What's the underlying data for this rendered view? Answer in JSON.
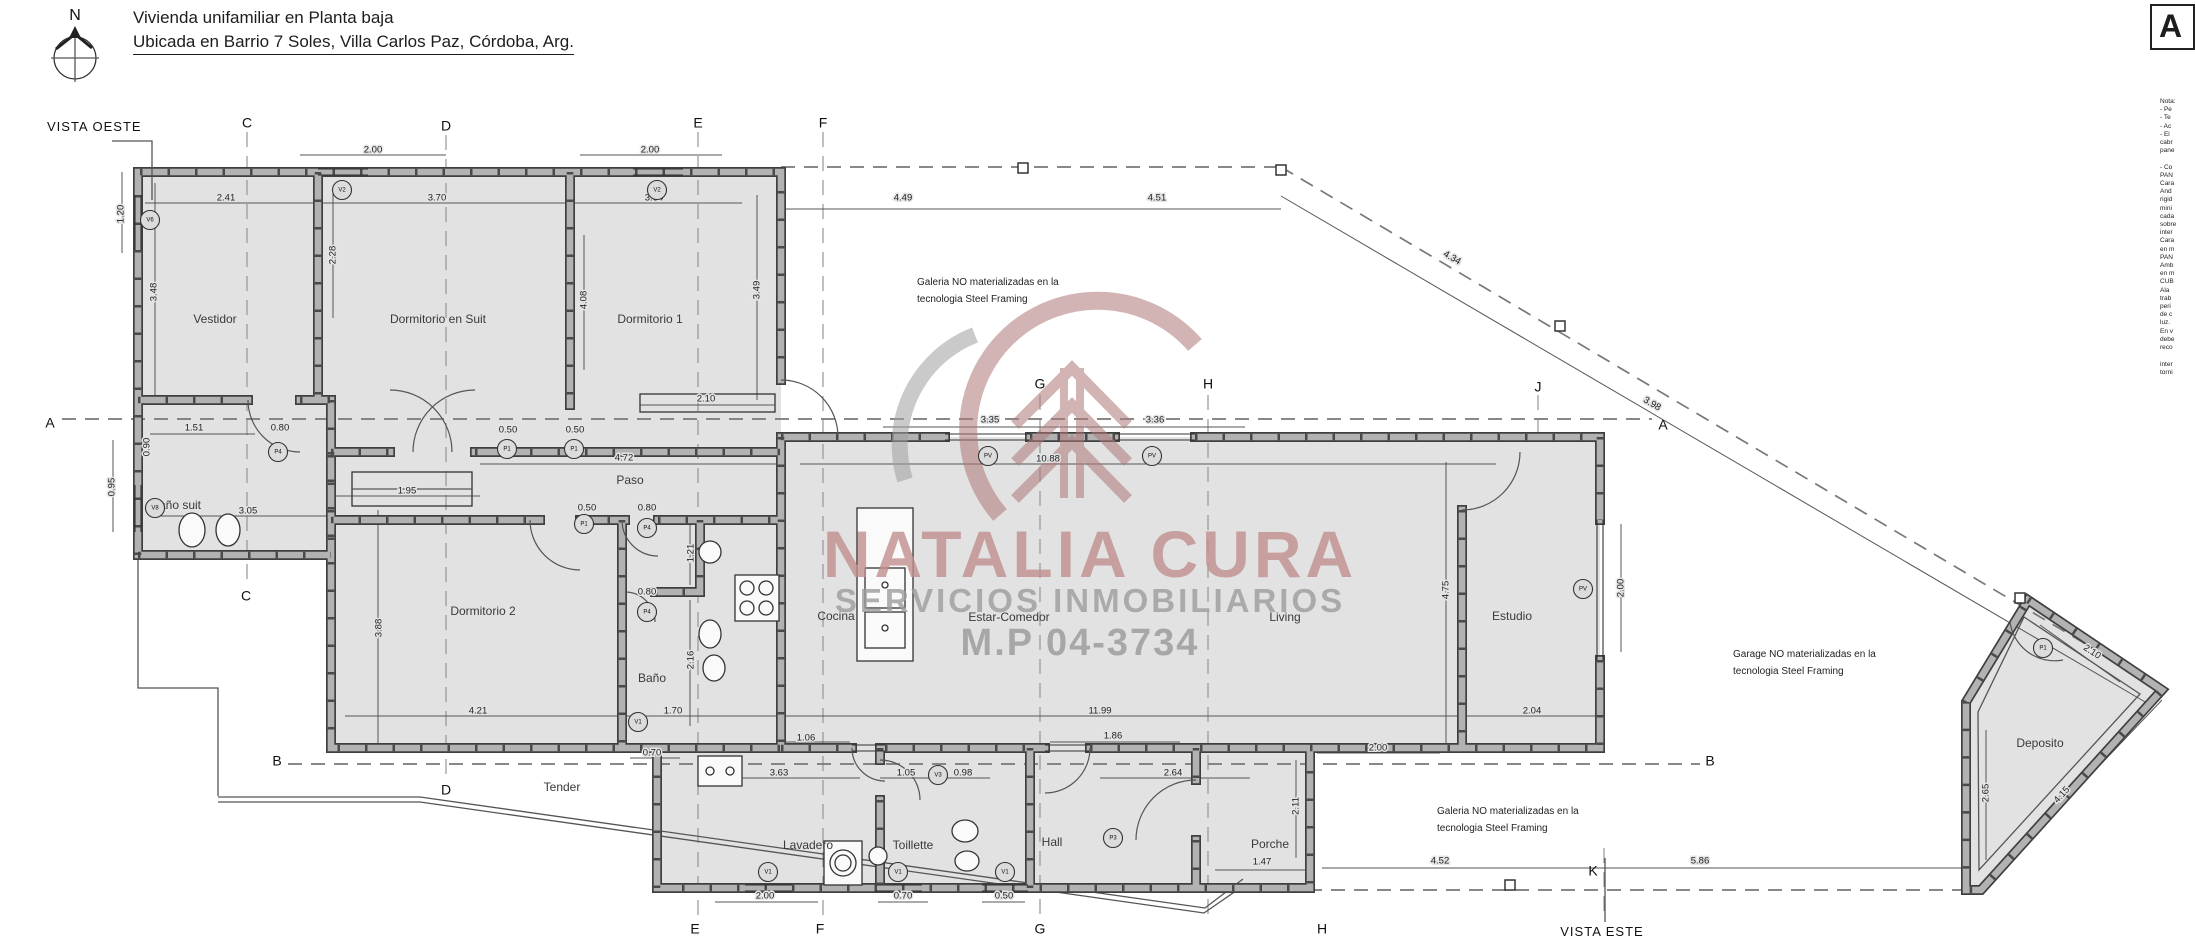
{
  "header": {
    "north_letter": "N",
    "title": "Vivienda unifamiliar en Planta baja",
    "subtitle": "Ubicada en Barrio 7 Soles, Villa Carlos Paz, Córdoba, Arg."
  },
  "views": {
    "west": "VISTA OESTE",
    "east": "VISTA ESTE"
  },
  "watermark": {
    "name": "NATALIA CURA",
    "tagline": "SERVICIOS INMOBILIARIOS",
    "license": "M.P 04-3734",
    "name_color": "#c18f8f",
    "gray_color": "#9d9d9d"
  },
  "rooms": [
    {
      "name": "Vestidor",
      "x": 215,
      "y": 320
    },
    {
      "name": "Dormitorio en Suit",
      "x": 438,
      "y": 320
    },
    {
      "name": "Dormitorio 1",
      "x": 650,
      "y": 320
    },
    {
      "name": "Baño suit",
      "x": 176,
      "y": 506
    },
    {
      "name": "Paso",
      "x": 630,
      "y": 481
    },
    {
      "name": "Dormitorio 2",
      "x": 483,
      "y": 612
    },
    {
      "name": "Baño",
      "x": 652,
      "y": 679
    },
    {
      "name": "Cocina",
      "x": 836,
      "y": 617
    },
    {
      "name": "Estar-Comedor",
      "x": 1009,
      "y": 618
    },
    {
      "name": "Living",
      "x": 1285,
      "y": 618
    },
    {
      "name": "Estudio",
      "x": 1512,
      "y": 617
    },
    {
      "name": "Lavadero",
      "x": 808,
      "y": 846
    },
    {
      "name": "Toillette",
      "x": 913,
      "y": 846
    },
    {
      "name": "Hall",
      "x": 1052,
      "y": 843
    },
    {
      "name": "Porche",
      "x": 1270,
      "y": 845
    },
    {
      "name": "Deposito",
      "x": 2040,
      "y": 744
    },
    {
      "name": "Tender",
      "x": 562,
      "y": 788
    }
  ],
  "grid_labels": [
    {
      "t": "C",
      "x": 247,
      "y": 124
    },
    {
      "t": "D",
      "x": 446,
      "y": 127
    },
    {
      "t": "E",
      "x": 698,
      "y": 124
    },
    {
      "t": "F",
      "x": 823,
      "y": 124
    },
    {
      "t": "G",
      "x": 1040,
      "y": 385
    },
    {
      "t": "H",
      "x": 1208,
      "y": 385
    },
    {
      "t": "J",
      "x": 1538,
      "y": 388
    },
    {
      "t": "A",
      "x": 50,
      "y": 424
    },
    {
      "t": "A",
      "x": 1663,
      "y": 426
    },
    {
      "t": "B",
      "x": 277,
      "y": 762
    },
    {
      "t": "B",
      "x": 1710,
      "y": 762
    },
    {
      "t": "C",
      "x": 246,
      "y": 597
    },
    {
      "t": "D",
      "x": 446,
      "y": 791
    },
    {
      "t": "E",
      "x": 695,
      "y": 930
    },
    {
      "t": "F",
      "x": 820,
      "y": 930
    },
    {
      "t": "G",
      "x": 1040,
      "y": 930
    },
    {
      "t": "H",
      "x": 1322,
      "y": 930
    },
    {
      "t": "K",
      "x": 1593,
      "y": 872
    }
  ],
  "notes": [
    {
      "lines": [
        "Galeria NO materializadas en la",
        "tecnologia Steel Framing"
      ],
      "x": 917,
      "y": 285
    },
    {
      "lines": [
        "Galeria NO materializadas en la",
        "tecnologia Steel Framing"
      ],
      "x": 1437,
      "y": 814
    },
    {
      "lines": [
        "Garage NO materializadas en la",
        "tecnologia Steel Framing"
      ],
      "x": 1733,
      "y": 657
    }
  ],
  "dimensions": [
    {
      "t": "2.00",
      "x": 373,
      "y": 150
    },
    {
      "t": "2.00",
      "x": 650,
      "y": 150
    },
    {
      "t": "2.41",
      "x": 226,
      "y": 198
    },
    {
      "t": "3.70",
      "x": 437,
      "y": 198
    },
    {
      "t": "3.64",
      "x": 654,
      "y": 198
    },
    {
      "t": "4.49",
      "x": 903,
      "y": 198
    },
    {
      "t": "4.51",
      "x": 1157,
      "y": 198
    },
    {
      "t": "1.20",
      "x": 121,
      "y": 214,
      "r": -90
    },
    {
      "t": "3.48",
      "x": 154,
      "y": 292,
      "r": -90
    },
    {
      "t": "2.28",
      "x": 333,
      "y": 255,
      "r": -90
    },
    {
      "t": "4.08",
      "x": 584,
      "y": 300,
      "r": -90
    },
    {
      "t": "3.49",
      "x": 757,
      "y": 290,
      "r": -90
    },
    {
      "t": "2.10",
      "x": 706,
      "y": 399
    },
    {
      "t": "1.51",
      "x": 194,
      "y": 428
    },
    {
      "t": "0.80",
      "x": 280,
      "y": 428
    },
    {
      "t": "0.90",
      "x": 147,
      "y": 447,
      "r": -90
    },
    {
      "t": "0.95",
      "x": 112,
      "y": 487,
      "r": -90
    },
    {
      "t": "3.05",
      "x": 248,
      "y": 511
    },
    {
      "t": "0.50",
      "x": 508,
      "y": 430
    },
    {
      "t": "0.50",
      "x": 575,
      "y": 430
    },
    {
      "t": "4.72",
      "x": 624,
      "y": 458
    },
    {
      "t": "1.95",
      "x": 407,
      "y": 491
    },
    {
      "t": "0.50",
      "x": 587,
      "y": 508
    },
    {
      "t": "0.80",
      "x": 647,
      "y": 508
    },
    {
      "t": "1.21",
      "x": 691,
      "y": 553,
      "r": -90
    },
    {
      "t": "0.80",
      "x": 647,
      "y": 592
    },
    {
      "t": "2.16",
      "x": 691,
      "y": 660,
      "r": -90
    },
    {
      "t": "3.88",
      "x": 379,
      "y": 628,
      "r": -90
    },
    {
      "t": "4.21",
      "x": 478,
      "y": 711
    },
    {
      "t": "1.70",
      "x": 673,
      "y": 711
    },
    {
      "t": "3.35",
      "x": 990,
      "y": 420
    },
    {
      "t": "3.36",
      "x": 1155,
      "y": 420
    },
    {
      "t": "10.88",
      "x": 1048,
      "y": 459
    },
    {
      "t": "4.75",
      "x": 1446,
      "y": 590,
      "r": -90
    },
    {
      "t": "2.00",
      "x": 1621,
      "y": 588,
      "r": -90
    },
    {
      "t": "2.04",
      "x": 1532,
      "y": 711
    },
    {
      "t": "11.99",
      "x": 1100,
      "y": 711
    },
    {
      "t": "1.06",
      "x": 806,
      "y": 738
    },
    {
      "t": "1.86",
      "x": 1113,
      "y": 736
    },
    {
      "t": "0.70",
      "x": 652,
      "y": 753
    },
    {
      "t": "3.63",
      "x": 779,
      "y": 773
    },
    {
      "t": "1.05",
      "x": 906,
      "y": 773
    },
    {
      "t": "0.98",
      "x": 963,
      "y": 773
    },
    {
      "t": "2.64",
      "x": 1173,
      "y": 773
    },
    {
      "t": "2.11",
      "x": 1296,
      "y": 806,
      "r": -90
    },
    {
      "t": "1.47",
      "x": 1262,
      "y": 862
    },
    {
      "t": "2.00",
      "x": 1378,
      "y": 748
    },
    {
      "t": "2.00",
      "x": 765,
      "y": 896
    },
    {
      "t": "0.70",
      "x": 903,
      "y": 896
    },
    {
      "t": "0.50",
      "x": 1004,
      "y": 896
    },
    {
      "t": "4.52",
      "x": 1440,
      "y": 861
    },
    {
      "t": "5.86",
      "x": 1700,
      "y": 861
    },
    {
      "t": "4.34",
      "x": 1452,
      "y": 258,
      "r": 30
    },
    {
      "t": "3.98",
      "x": 1652,
      "y": 404,
      "r": 30
    },
    {
      "t": "2.10",
      "x": 2092,
      "y": 652,
      "r": 33
    },
    {
      "t": "4.15",
      "x": 2062,
      "y": 795,
      "r": -48
    },
    {
      "t": "2.65",
      "x": 1986,
      "y": 793,
      "r": -90
    }
  ],
  "markers": [
    {
      "t": "V2",
      "x": 342,
      "y": 190
    },
    {
      "t": "V2",
      "x": 657,
      "y": 190
    },
    {
      "t": "V6",
      "x": 150,
      "y": 220
    },
    {
      "t": "V8",
      "x": 155,
      "y": 508
    },
    {
      "t": "P4",
      "x": 278,
      "y": 452
    },
    {
      "t": "P1",
      "x": 507,
      "y": 449
    },
    {
      "t": "P1",
      "x": 574,
      "y": 449
    },
    {
      "t": "P1",
      "x": 584,
      "y": 524
    },
    {
      "t": "P4",
      "x": 647,
      "y": 528
    },
    {
      "t": "P4",
      "x": 647,
      "y": 612
    },
    {
      "t": "V1",
      "x": 638,
      "y": 722
    },
    {
      "t": "PV",
      "x": 988,
      "y": 456
    },
    {
      "t": "PV",
      "x": 1152,
      "y": 456
    },
    {
      "t": "PV",
      "x": 1583,
      "y": 589
    },
    {
      "t": "V1",
      "x": 768,
      "y": 872
    },
    {
      "t": "V1",
      "x": 898,
      "y": 872
    },
    {
      "t": "V1",
      "x": 1005,
      "y": 872
    },
    {
      "t": "V3",
      "x": 938,
      "y": 775
    },
    {
      "t": "P3",
      "x": 1113,
      "y": 838
    },
    {
      "t": "P1",
      "x": 2043,
      "y": 648
    }
  ],
  "side_panel": {
    "box_letter": "A",
    "lines": [
      "Nota:",
      "- Pe",
      "- Te",
      "- Ac",
      "- El",
      "cabr",
      "pane",
      "",
      "- Co",
      "PAN",
      "Cara",
      "And",
      "rigid",
      "mini",
      "cada",
      "sobre",
      "inter",
      "Cara",
      "en m",
      "PAN",
      "Amb",
      "en m",
      "CUB",
      "Ala",
      "trab",
      "peri",
      "de c",
      "luz.",
      "En v",
      "debe",
      "reco",
      "",
      "inter",
      "torni"
    ]
  }
}
